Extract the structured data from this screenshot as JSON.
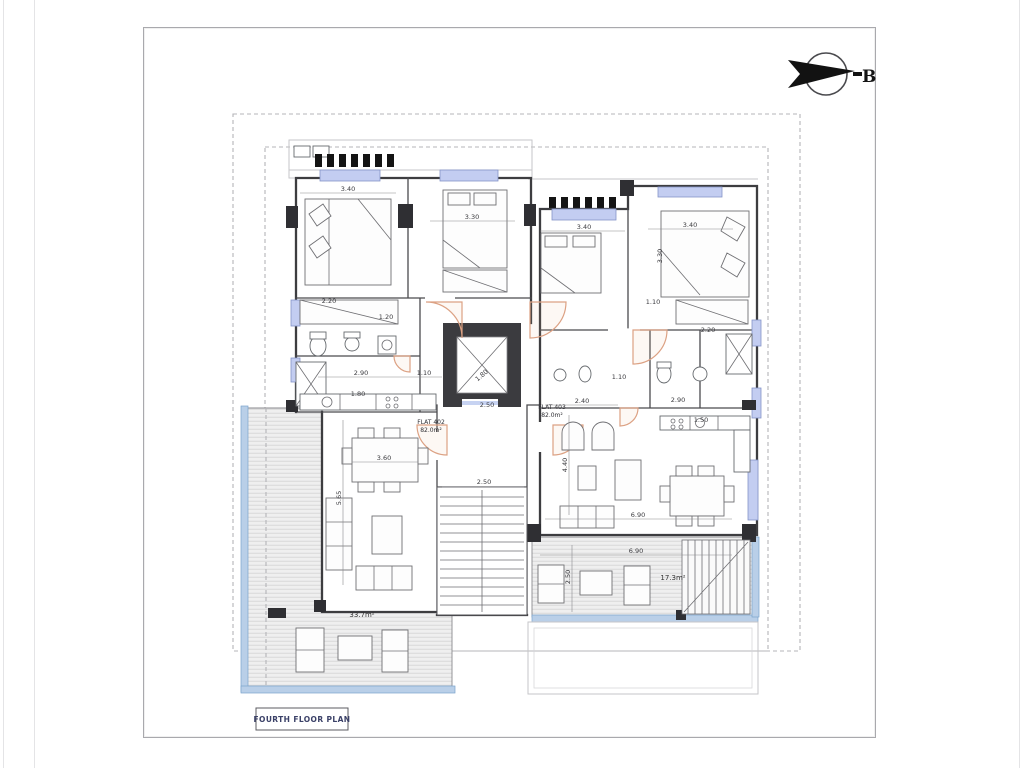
{
  "sheet": {
    "title": "FOURTH FLOOR PLAN"
  },
  "north_arrow": {
    "label": "B"
  },
  "colors": {
    "wall": "#3d3d40",
    "window_fill": "#c3cdf1",
    "window_stroke": "#8494c9",
    "door_swing": "#dca183",
    "terrace_hatch": "#d2d2d4",
    "glass_rail": "#b9cfe8",
    "boundary_dash": "#b4b4b8",
    "title_text": "#3b4168"
  },
  "flats": [
    {
      "name": "FLAT 402",
      "area": "82.0m²"
    },
    {
      "name": "FLAT 403",
      "area": "82.0m²"
    }
  ],
  "plan": {
    "labels": [
      {
        "t": "3.40",
        "x": 348,
        "y": 191
      },
      {
        "t": "3.30",
        "x": 472,
        "y": 219
      },
      {
        "t": "3.40",
        "x": 584,
        "y": 229
      },
      {
        "t": "3.40",
        "x": 690,
        "y": 227
      },
      {
        "t": "3.30",
        "x": 662,
        "y": 256,
        "r": -90
      },
      {
        "t": "2.20",
        "x": 329,
        "y": 303
      },
      {
        "t": "1.20",
        "x": 386,
        "y": 319
      },
      {
        "t": "2.90",
        "x": 361,
        "y": 375
      },
      {
        "t": "1.10",
        "x": 424,
        "y": 375
      },
      {
        "t": "1.80",
        "x": 358,
        "y": 396
      },
      {
        "t": "1.80",
        "x": 483,
        "y": 377,
        "r": -40
      },
      {
        "t": "2.50",
        "x": 487,
        "y": 407
      },
      {
        "t": "2.40",
        "x": 582,
        "y": 403
      },
      {
        "t": "1.10",
        "x": 619,
        "y": 379
      },
      {
        "t": "1.10",
        "x": 653,
        "y": 304
      },
      {
        "t": "2.20",
        "x": 708,
        "y": 332
      },
      {
        "t": "2.90",
        "x": 678,
        "y": 402
      },
      {
        "t": "1.50",
        "x": 701,
        "y": 422
      },
      {
        "t": "4.40",
        "x": 567,
        "y": 465,
        "r": -90
      },
      {
        "t": "6.90",
        "x": 638,
        "y": 517
      },
      {
        "t": "3.60",
        "x": 384,
        "y": 460
      },
      {
        "t": "5.65",
        "x": 341,
        "y": 498,
        "r": -90
      },
      {
        "t": "2.50",
        "x": 484,
        "y": 484
      },
      {
        "t": "6.90",
        "x": 636,
        "y": 553
      },
      {
        "t": "2.50",
        "x": 570,
        "y": 577,
        "r": -90
      },
      {
        "t": "33.7m²",
        "x": 362,
        "y": 617,
        "k": "area"
      },
      {
        "t": "17.3m²",
        "x": 673,
        "y": 580,
        "k": "area"
      },
      {
        "t": "FLAT 402",
        "x": 431,
        "y": 424,
        "k": "flat"
      },
      {
        "t": "82.0m²",
        "x": 431,
        "y": 432,
        "k": "flat"
      },
      {
        "t": "FLAT 403",
        "x": 552,
        "y": 409,
        "k": "flat"
      },
      {
        "t": "82.0m²",
        "x": 552,
        "y": 417,
        "k": "flat"
      }
    ]
  }
}
